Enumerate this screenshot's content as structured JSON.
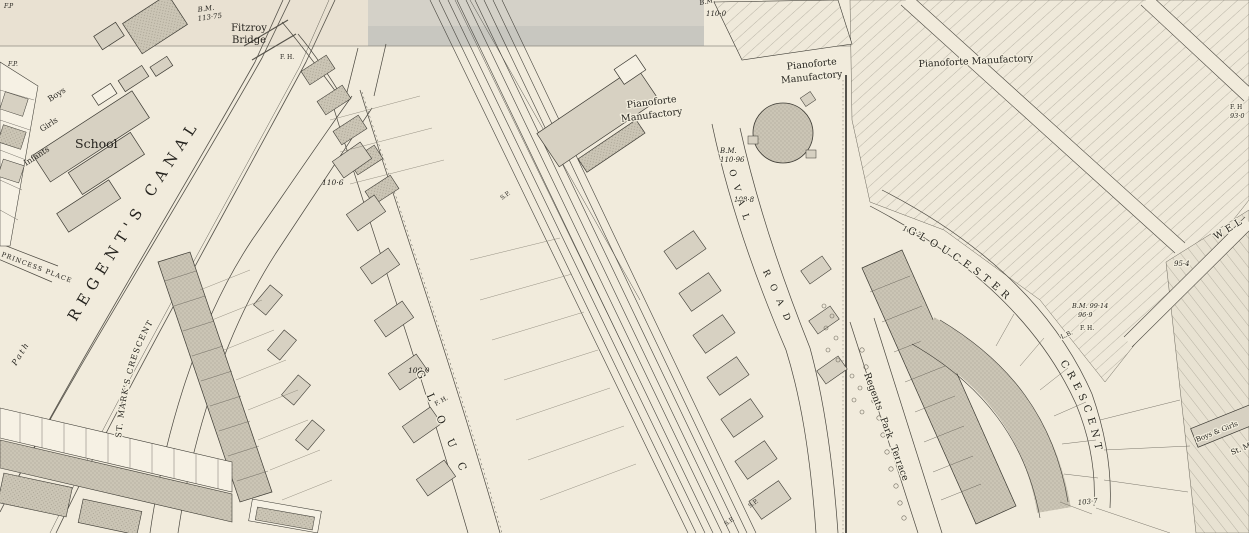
{
  "map": {
    "palette": {
      "paper": "#f1ebdc",
      "paper_top_sheet": "#e9e1d2",
      "canal_water": "#d4d1c8",
      "building_light": "#d7d1c2",
      "building_stipple": "#c9c3b3",
      "line_ink": "#3c3a33",
      "text_ink": "#26241f"
    },
    "labels": {
      "fp_corner": "F.P",
      "fp_left": "F.P.",
      "bm_bridge": "B.M.",
      "bm_bridge_val": "113·75",
      "fitzroy_1": "Fitzroy",
      "fitzroy_2": "Bridge",
      "fh_bridge": "F. H.",
      "school": "School",
      "boys": "Boys",
      "girls": "Girls",
      "infants": "Infants",
      "princess_place": "PRINCESS PLACE",
      "regents_canal": "REGENT'S  CANAL",
      "towing_path": "Path",
      "st_marks_crescent": "ST. MARK'S  CRESCENT",
      "spot_110_6": "110·6",
      "spot_109_0": "109·0",
      "bm_top": "B.M.",
      "spot_110_0": "110·0",
      "sp_rail": "S.P.",
      "glouc": "GLOUC",
      "fh_glouc": "F. H.",
      "piano1_1": "Pianoforte",
      "piano1_2": "Manufactory",
      "piano2_1": "Pianoforte",
      "piano2_2": "Manufactory",
      "piano3": "Pianoforte Manufactory",
      "bm_oval": "B.M.",
      "bm_oval_val": "110·96",
      "spot_108_8": "108·8",
      "oval": "OVAL",
      "road": "ROAD",
      "spot_103_2": "103·2",
      "gloucester": "GLOUCESTER",
      "crescent": "CRESCENT",
      "bm_99": "B.M. 99·14",
      "spot_96_9": "96·9",
      "fh_crescent": "F. H.",
      "lb_crescent": "L.B.",
      "spot_103_7": "103·7",
      "regents_park_terrace": "Regents Park Terrace",
      "wel": "WEL",
      "spot_95_4": "95·4",
      "fh_right": "F. H",
      "spot_93_0": "93·0",
      "boys_girls": "Boys & Girls",
      "st_m": "St. M",
      "sp_bottom_1": "S.P.",
      "sp_bottom_2": "S.P."
    }
  }
}
